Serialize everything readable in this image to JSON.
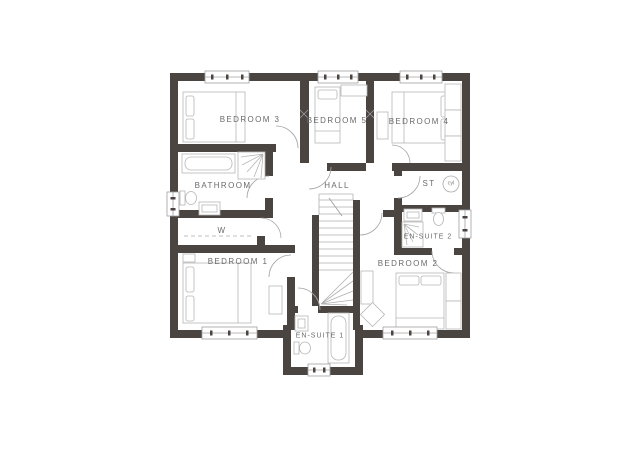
{
  "plan": {
    "type": "first-floor-plan",
    "rooms": [
      {
        "id": "bedroom3",
        "label": "BEDROOM 3"
      },
      {
        "id": "bedroom5",
        "label": "BEDROOM 5"
      },
      {
        "id": "bedroom4",
        "label": "BEDROOM 4"
      },
      {
        "id": "bathroom",
        "label": "BATHROOM"
      },
      {
        "id": "hall",
        "label": "HALL"
      },
      {
        "id": "store",
        "label": "ST"
      },
      {
        "id": "wardrobe",
        "label": "W"
      },
      {
        "id": "ensuite2",
        "label": "EN-SUITE 2"
      },
      {
        "id": "bedroom1",
        "label": "BEDROOM 1"
      },
      {
        "id": "bedroom2",
        "label": "BEDROOM 2"
      },
      {
        "id": "ensuite1",
        "label": "EN-SUITE 1"
      }
    ],
    "cylinder_label": "cyl",
    "colors": {
      "wall": "#4b4542",
      "fixture_line": "#b6b6b6",
      "door_arc": "#a6a6a6",
      "text": "#6a6a6a",
      "background": "#ffffff"
    }
  }
}
